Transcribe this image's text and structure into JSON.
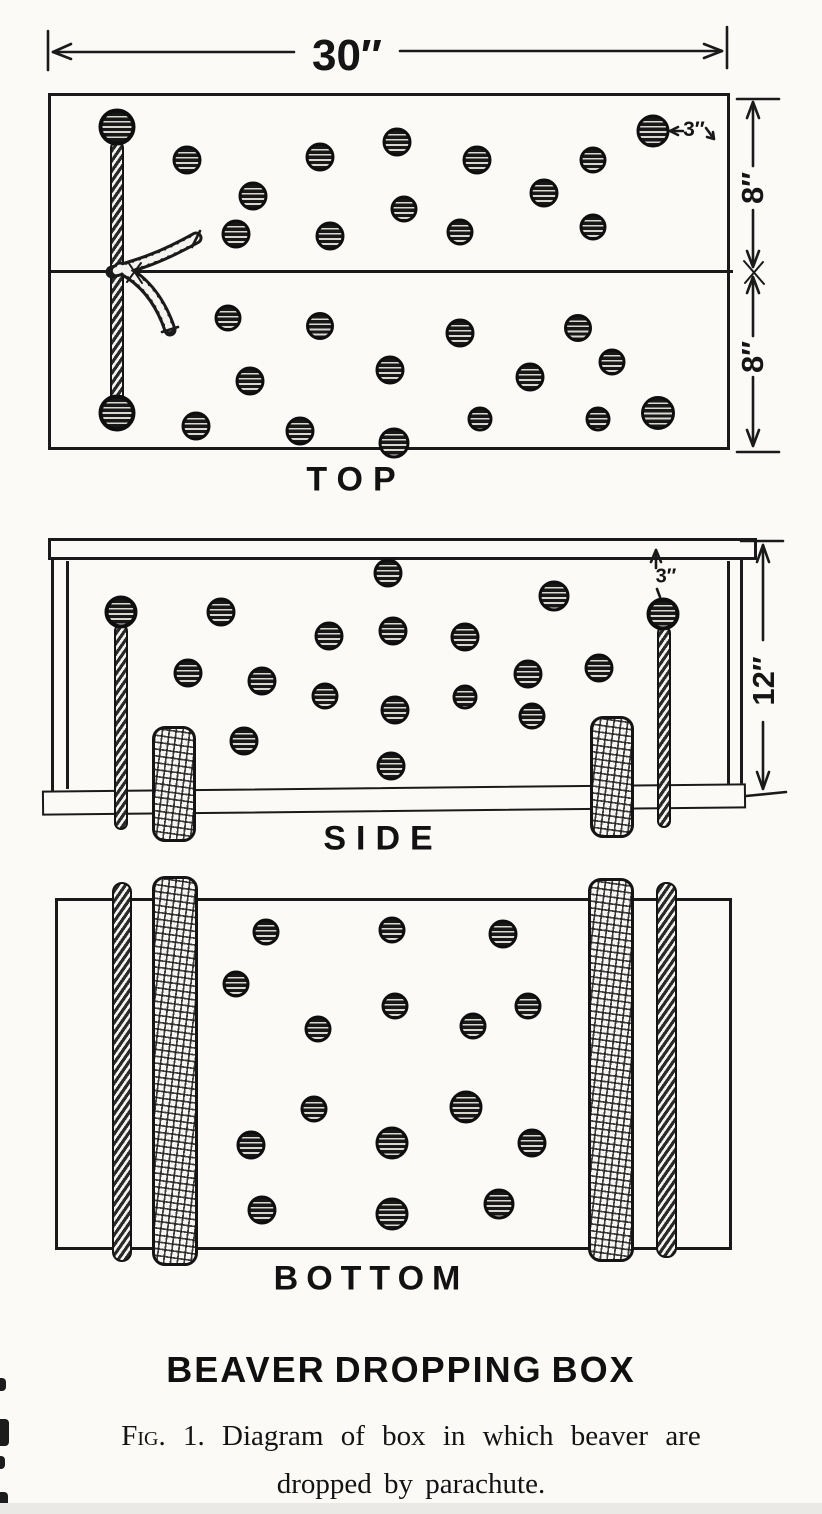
{
  "figure": {
    "title": "BEAVER DROPPING BOX",
    "caption": {
      "fig_label": "Fig. 1.",
      "line1_rest": "Diagram of box in which beaver are",
      "line2": "dropped by parachute."
    }
  },
  "dimensions": {
    "top_width": "30″",
    "top_upper_half": "8″",
    "top_lower_half": "8″",
    "top_hole_size": "3″",
    "side_height": "12″",
    "side_hole_offset": "3″"
  },
  "views": {
    "top": {
      "label": "TOP",
      "holes": [
        [
          187,
          160,
          29
        ],
        [
          253,
          196,
          29
        ],
        [
          236,
          234,
          29
        ],
        [
          320,
          157,
          29
        ],
        [
          330,
          236,
          29
        ],
        [
          397,
          142,
          29
        ],
        [
          404,
          209,
          27
        ],
        [
          460,
          232,
          27
        ],
        [
          477,
          160,
          29
        ],
        [
          544,
          193,
          29
        ],
        [
          593,
          160,
          27
        ],
        [
          593,
          227,
          27
        ],
        [
          653,
          131,
          33
        ],
        [
          228,
          318,
          27
        ],
        [
          320,
          326,
          28
        ],
        [
          460,
          333,
          29
        ],
        [
          578,
          328,
          28
        ],
        [
          250,
          381,
          29
        ],
        [
          390,
          370,
          29
        ],
        [
          530,
          377,
          29
        ],
        [
          612,
          362,
          27
        ],
        [
          196,
          426,
          29
        ],
        [
          300,
          431,
          29
        ],
        [
          394,
          443,
          31
        ],
        [
          480,
          419,
          25
        ],
        [
          598,
          419,
          25
        ],
        [
          658,
          413,
          34
        ]
      ],
      "rope_holes": [
        [
          117,
          127,
          37
        ],
        [
          117,
          413,
          37
        ]
      ]
    },
    "side": {
      "label": "SIDE",
      "holes": [
        [
          388,
          573,
          29
        ],
        [
          554,
          596,
          31
        ],
        [
          221,
          612,
          29
        ],
        [
          329,
          636,
          29
        ],
        [
          393,
          631,
          29
        ],
        [
          465,
          637,
          29
        ],
        [
          188,
          673,
          29
        ],
        [
          262,
          681,
          29
        ],
        [
          528,
          674,
          29
        ],
        [
          599,
          668,
          29
        ],
        [
          325,
          696,
          27
        ],
        [
          395,
          710,
          29
        ],
        [
          465,
          697,
          25
        ],
        [
          532,
          716,
          27
        ],
        [
          244,
          741,
          29
        ],
        [
          391,
          766,
          29
        ]
      ],
      "rope_holes": [
        [
          121,
          612,
          33
        ],
        [
          663,
          614,
          33
        ]
      ]
    },
    "bottom": {
      "label": "BOTTOM",
      "holes": [
        [
          266,
          932,
          27
        ],
        [
          392,
          930,
          27
        ],
        [
          503,
          934,
          29
        ],
        [
          236,
          984,
          27
        ],
        [
          318,
          1029,
          27
        ],
        [
          395,
          1006,
          27
        ],
        [
          473,
          1026,
          27
        ],
        [
          528,
          1006,
          27
        ],
        [
          314,
          1109,
          27
        ],
        [
          466,
          1107,
          33
        ],
        [
          251,
          1145,
          29
        ],
        [
          392,
          1143,
          33
        ],
        [
          532,
          1143,
          29
        ],
        [
          262,
          1210,
          29
        ],
        [
          392,
          1214,
          33
        ],
        [
          499,
          1204,
          31
        ]
      ]
    }
  },
  "ink_color": "#1a1a1a",
  "paper_color": "#fbfaf7"
}
